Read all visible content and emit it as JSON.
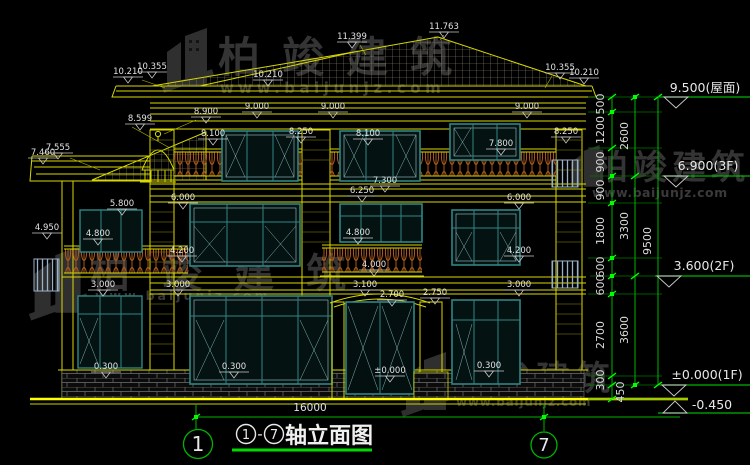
{
  "watermark": {
    "brand": "柏竣建筑",
    "url": "www.baijunjz.com"
  },
  "title": {
    "axis_from": "1",
    "separator": "-",
    "axis_to": "7",
    "text": "轴立面图"
  },
  "axes": {
    "left": "1",
    "right": "7"
  },
  "overall_dim": "16000",
  "levels": [
    {
      "label": "9.500(屋面)"
    },
    {
      "label": "6.900(3F)"
    },
    {
      "label": "3.600(2F)"
    },
    {
      "label": "±0.000(1F)"
    },
    {
      "label": "-0.450"
    }
  ],
  "dims": {
    "inner": [
      "500",
      "1200",
      "900",
      "900",
      "1800",
      "600",
      "600",
      "2700",
      "300"
    ],
    "mid": [
      "2600",
      "3300",
      "3600"
    ],
    "total": "9500",
    "below_ground": "450"
  },
  "elevation_labels": [
    "8.900",
    "8.599",
    "7.460",
    "7.555",
    "10.210",
    "10.355",
    "10.210",
    "11.399",
    "11.763",
    "10.355",
    "10.210",
    "9.000",
    "9.000",
    "9.000",
    "8.100",
    "8.250",
    "8.100",
    "8.250",
    "7.800",
    "7.300",
    "6.250",
    "6.000",
    "6.000",
    "5.800",
    "4.950",
    "4.800",
    "4.800",
    "4.200",
    "4.200",
    "4.000",
    "3.000",
    "3.000",
    "3.100",
    "3.000",
    "2.700",
    "2.750",
    "0.300",
    "0.300",
    "0.300",
    "±0.000"
  ]
}
